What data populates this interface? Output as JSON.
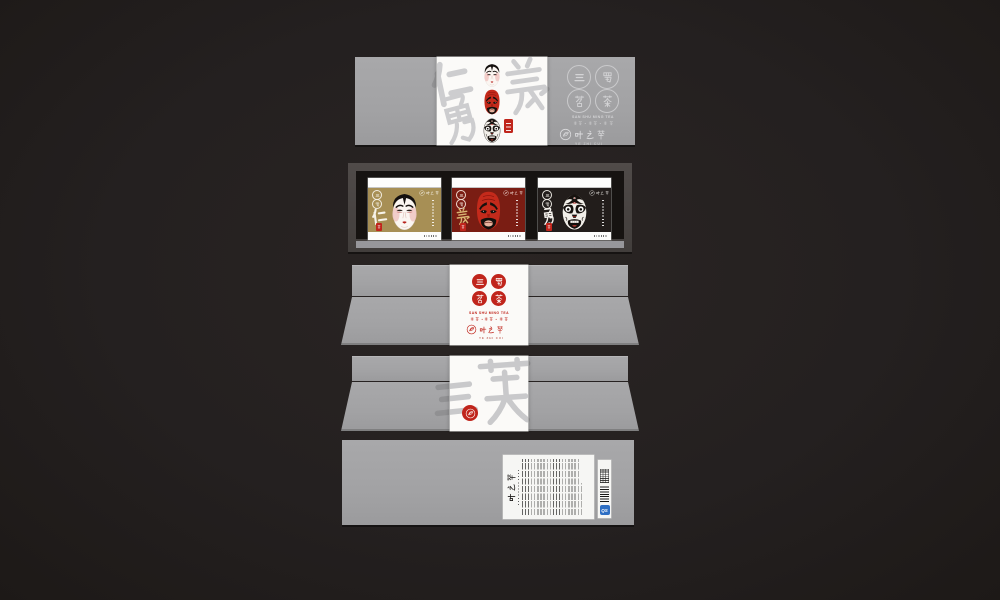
{
  "brand": {
    "name_cn": "叶之萃",
    "name_en": "YE ZHI CUI",
    "series_seals": [
      "三",
      "蜀",
      "茗",
      "茶"
    ],
    "series_name_cn": "三蜀茗茶",
    "series_name_en": "SAN SHU MING TEA",
    "tea_types_line": "红茶·绿茶·花茶"
  },
  "lid": {
    "watermark": "仁義勇"
  },
  "tray": {
    "boxes": [
      {
        "virtue": "仁",
        "mask": "liubei-opera-mask",
        "bg": "#a78f55",
        "virtue_color": "#f7f3ea"
      },
      {
        "virtue": "義",
        "mask": "guanyu-opera-mask",
        "bg": "#7a1d13",
        "virtue_color": "#d8b472"
      },
      {
        "virtue": "勇",
        "mask": "zhangfei-opera-mask",
        "bg": "#221d1b",
        "virtue_color": "#f4f1ec"
      }
    ],
    "mini_seals": [
      "三",
      "蜀"
    ]
  },
  "sleeve_front": {
    "seal_grid": [
      "三",
      "蜀",
      "茗",
      "茶"
    ],
    "series_en": "SAN SHU MING TEA",
    "tea_types_line": "红茶·绿茶·花茶",
    "brand": "叶之萃"
  },
  "sleeve_back": {
    "watermark": "三英"
  },
  "bottom": {
    "brand": "叶之萃",
    "qs_label": "QS"
  },
  "colors": {
    "accent_red": "#c0251c",
    "gold_box": "#a78f55",
    "dark_red_box": "#7a1d13",
    "black_box": "#221d1b",
    "panel_gray": "#a2a2a4",
    "background": "#242020",
    "qs_blue": "#2f6fc4"
  }
}
